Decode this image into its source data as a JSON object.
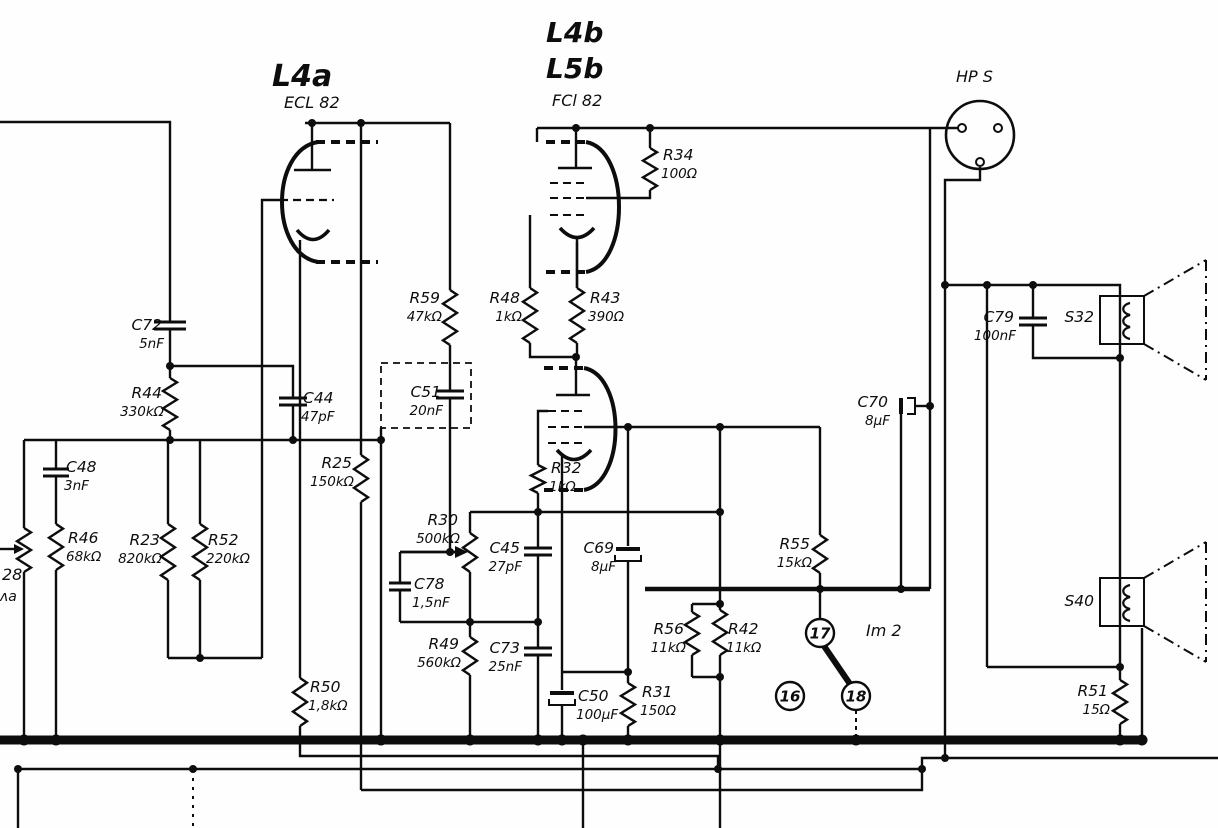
{
  "schematic": {
    "texts": [
      {
        "name": "tube-l4a-name",
        "text": "L4a",
        "x": 272,
        "y": 86,
        "size": 30,
        "bold": true
      },
      {
        "name": "tube-l4a-type",
        "text": "ECL 82",
        "x": 284,
        "y": 108,
        "size": 16,
        "bold": false
      },
      {
        "name": "tube-l4b-name",
        "text": "L4b",
        "x": 546,
        "y": 42,
        "size": 28,
        "bold": true
      },
      {
        "name": "tube-l5b-name",
        "text": "L5b",
        "x": 546,
        "y": 78,
        "size": 28,
        "bold": true
      },
      {
        "name": "tube-l4b-type",
        "text": "FCl 82",
        "x": 552,
        "y": 106,
        "size": 16,
        "bold": false
      },
      {
        "name": "hps-connector-label",
        "text": "HP S",
        "x": 956,
        "y": 82,
        "size": 16,
        "bold": false
      },
      {
        "name": "switch-label",
        "text": "Im 2",
        "x": 866,
        "y": 636,
        "size": 16,
        "bold": false
      },
      {
        "name": "pot-ref-partial",
        "text": "28",
        "x": 2,
        "y": 580,
        "size": 16,
        "bold": false
      },
      {
        "name": "pot-value-partial",
        "text": "ʌa",
        "x": 0,
        "y": 601,
        "size": 14,
        "bold": false
      }
    ],
    "components": [
      {
        "ref": "C72",
        "value": "5nF",
        "x": 162,
        "y": 330,
        "anchor": "end"
      },
      {
        "ref": "R44",
        "value": "330kΩ",
        "x": 162,
        "y": 398,
        "anchor": "end"
      },
      {
        "ref": "C44",
        "value": "47pF",
        "x": 303,
        "y": 403,
        "anchor": "start"
      },
      {
        "ref": "C48",
        "value": "3nF",
        "x": 66,
        "y": 472,
        "anchor": "start"
      },
      {
        "ref": "R46",
        "value": "68kΩ",
        "x": 68,
        "y": 543,
        "anchor": "start"
      },
      {
        "ref": "R23",
        "value": "820kΩ",
        "x": 160,
        "y": 545,
        "anchor": "end"
      },
      {
        "ref": "R52",
        "value": "220kΩ",
        "x": 208,
        "y": 545,
        "anchor": "start"
      },
      {
        "ref": "R59",
        "value": "47kΩ",
        "x": 440,
        "y": 303,
        "anchor": "end"
      },
      {
        "ref": "C51",
        "value": "20nF",
        "x": 441,
        "y": 397,
        "anchor": "end"
      },
      {
        "ref": "R25",
        "value": "150kΩ",
        "x": 352,
        "y": 468,
        "anchor": "end"
      },
      {
        "ref": "R48",
        "value": "1kΩ",
        "x": 520,
        "y": 303,
        "anchor": "end"
      },
      {
        "ref": "R43",
        "value": "390Ω",
        "x": 590,
        "y": 303,
        "anchor": "start"
      },
      {
        "ref": "R34",
        "value": "100Ω",
        "x": 663,
        "y": 160,
        "anchor": "start"
      },
      {
        "ref": "R32",
        "value": "1kΩ",
        "x": 551,
        "y": 473,
        "anchor": "start"
      },
      {
        "ref": "R30",
        "value": "500kΩ",
        "x": 458,
        "y": 525,
        "anchor": "end"
      },
      {
        "ref": "C45",
        "value": "27pF",
        "x": 520,
        "y": 553,
        "anchor": "end"
      },
      {
        "ref": "C78",
        "value": "1,5nF",
        "x": 414,
        "y": 589,
        "anchor": "start"
      },
      {
        "ref": "R49",
        "value": "560kΩ",
        "x": 459,
        "y": 649,
        "anchor": "end"
      },
      {
        "ref": "C73",
        "value": "25nF",
        "x": 520,
        "y": 653,
        "anchor": "end"
      },
      {
        "ref": "R50",
        "value": "1,8kΩ",
        "x": 310,
        "y": 692,
        "anchor": "start"
      },
      {
        "ref": "C50",
        "value": "100μF",
        "x": 578,
        "y": 701,
        "anchor": "start"
      },
      {
        "ref": "R31",
        "value": "150Ω",
        "x": 642,
        "y": 697,
        "anchor": "start"
      },
      {
        "ref": "C69",
        "value": "8μF",
        "x": 614,
        "y": 553,
        "anchor": "end"
      },
      {
        "ref": "C70",
        "value": "8μF",
        "x": 888,
        "y": 407,
        "anchor": "end"
      },
      {
        "ref": "R55",
        "value": "15kΩ",
        "x": 810,
        "y": 549,
        "anchor": "end"
      },
      {
        "ref": "R56",
        "value": "11kΩ",
        "x": 684,
        "y": 634,
        "anchor": "end"
      },
      {
        "ref": "R42",
        "value": "11kΩ",
        "x": 728,
        "y": 634,
        "anchor": "start"
      },
      {
        "ref": "C79",
        "value": "100nF",
        "x": 1014,
        "y": 322,
        "anchor": "end"
      },
      {
        "ref": "R51",
        "value": "15Ω",
        "x": 1108,
        "y": 696,
        "anchor": "end"
      },
      {
        "ref": "S32",
        "value": "",
        "x": 1094,
        "y": 322,
        "anchor": "end"
      },
      {
        "ref": "S40",
        "value": "",
        "x": 1094,
        "y": 606,
        "anchor": "end"
      }
    ],
    "terminals": [
      {
        "label": "16",
        "x": 790,
        "y": 696
      },
      {
        "label": "17",
        "x": 820,
        "y": 633
      },
      {
        "label": "18",
        "x": 856,
        "y": 696
      }
    ]
  }
}
